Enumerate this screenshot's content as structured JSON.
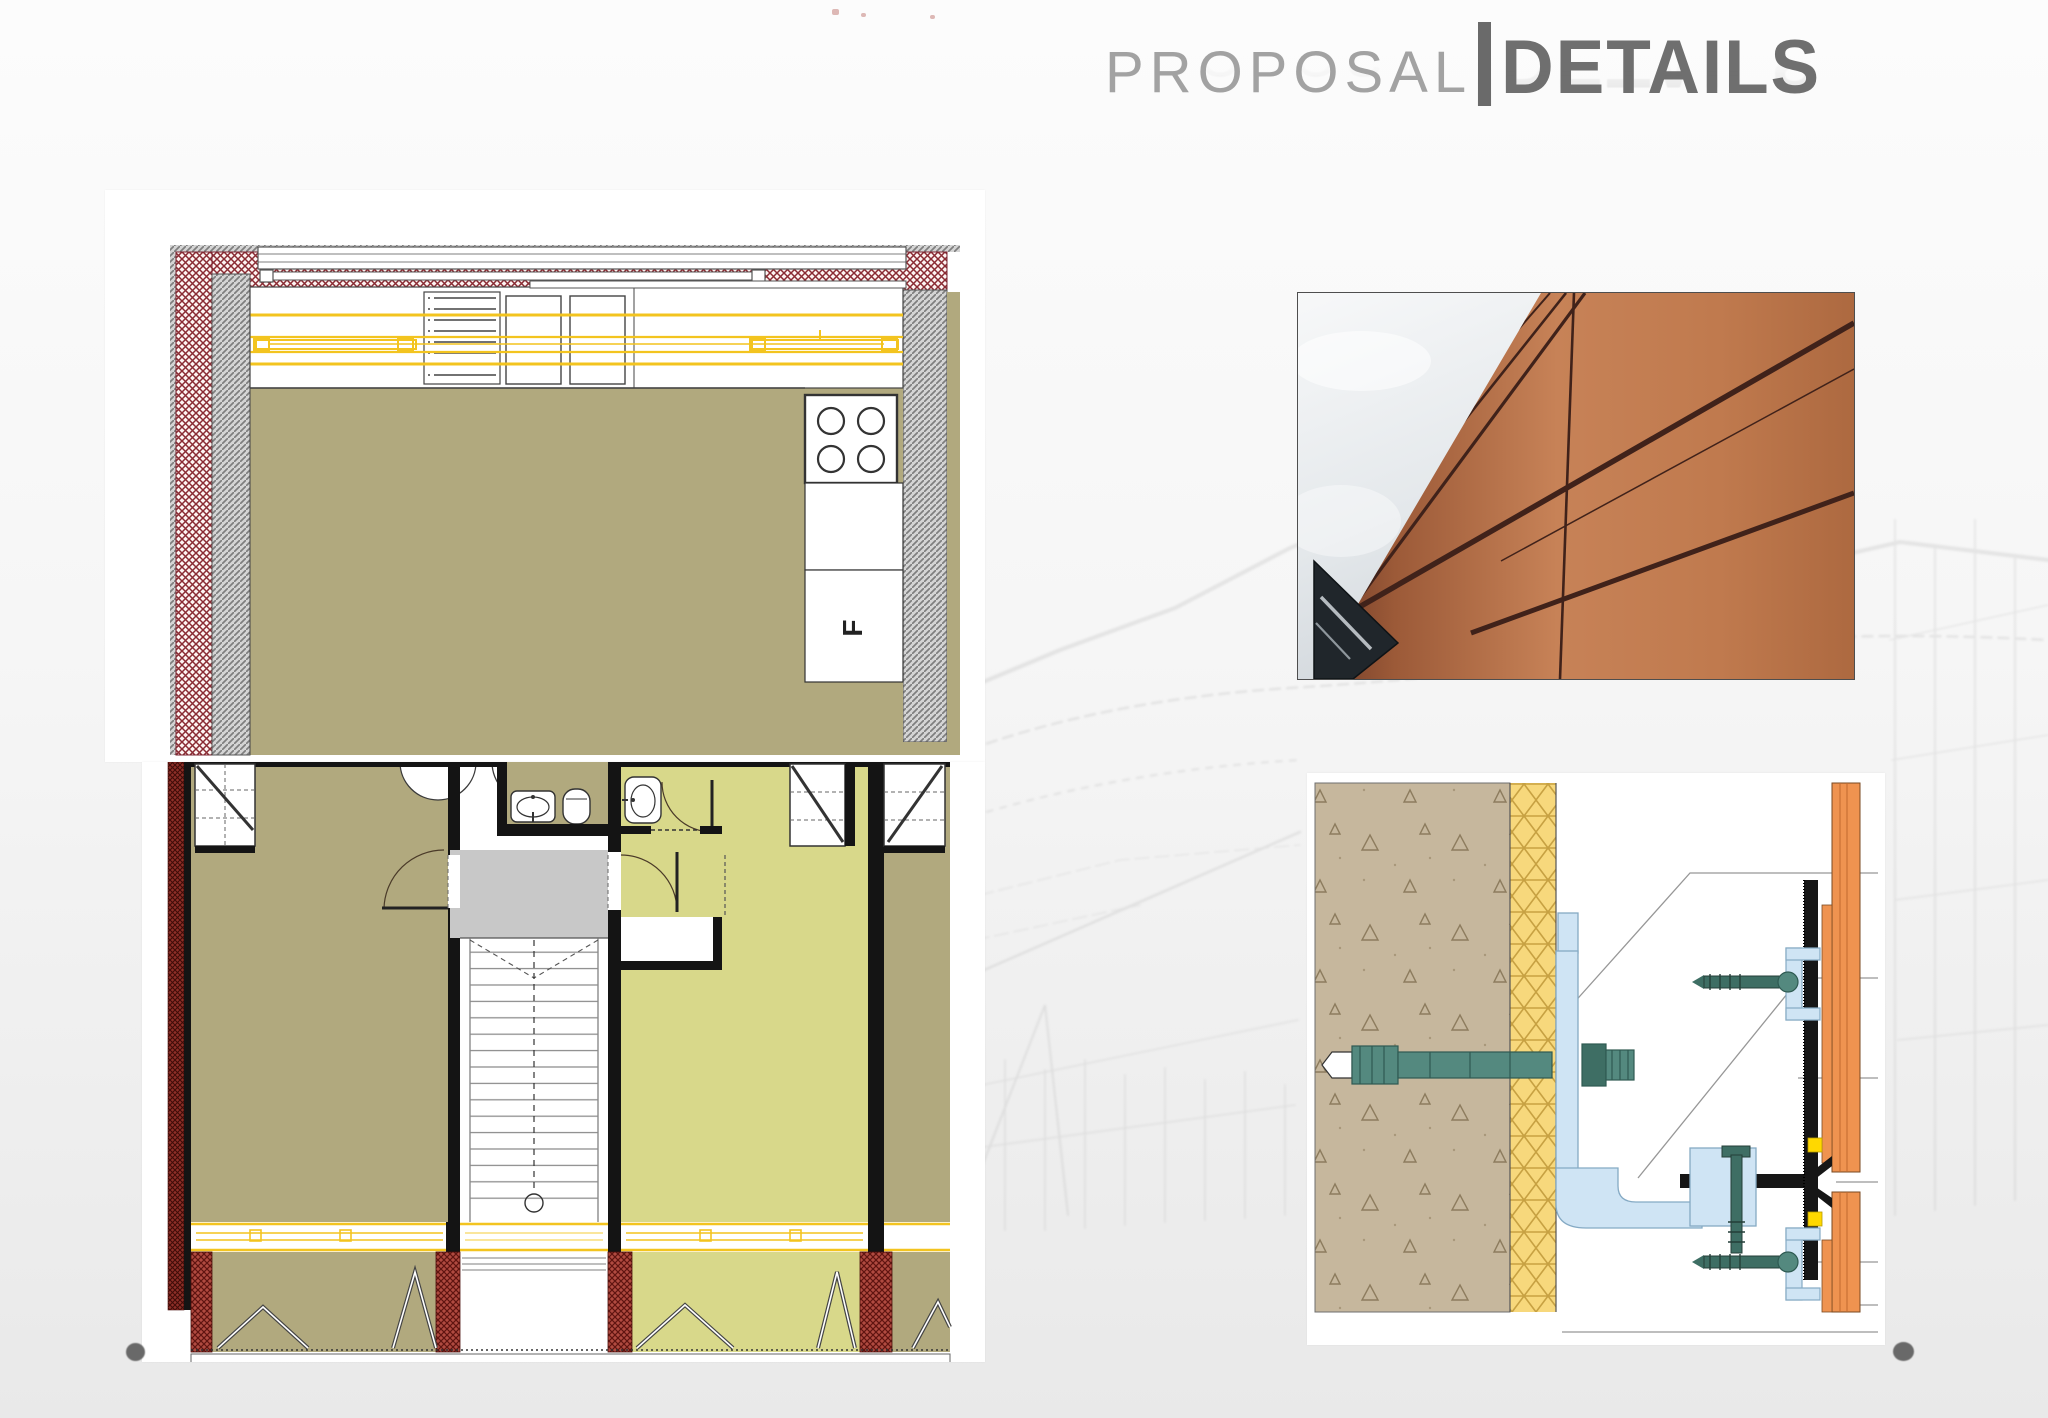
{
  "title": {
    "left": "PROPOSAL",
    "separator": "|",
    "right": "DETAILS"
  },
  "panels": {
    "kitchen_plan": {
      "semantic": "kitchen-floor-plan-drawing",
      "fridge_label": "F"
    },
    "apartment_plan": {
      "semantic": "upper-floor-plan-with-stair-drawing"
    },
    "facade_photo": {
      "semantic": "copper-panel-facade-photograph"
    },
    "anchor_detail": {
      "semantic": "ventilated-facade-anchor-section-detail"
    }
  },
  "decorations": {
    "background_sketch": "faded-construction-perspective-sketch",
    "bottom_left_dot": "slide-corner-dot",
    "bottom_right_dot": "slide-corner-dot"
  },
  "colors": {
    "page_bg_top": "#fcfcfc",
    "page_bg_bottom": "#e9e9e9",
    "title_light_gray": "#a2a2a2",
    "title_dark_gray": "#6f6f6f",
    "floor_khaki": "#b1a97e",
    "floor_yellow_green": "#d8d88a",
    "wall_black": "#141414",
    "wall_red_hatch": "#8a2b33",
    "brick_red": "#b04a40",
    "landing_gray": "#c8c8c8",
    "window_yellow": "#f3c41f",
    "concrete_tan": "#c6b79d",
    "insulation_yellow": "#f7d87c",
    "panel_orange": "#ef9350",
    "bracket_blue": "#cfe4f4",
    "anchor_teal": "#54897f",
    "facade_copper": "#c07a4e"
  }
}
